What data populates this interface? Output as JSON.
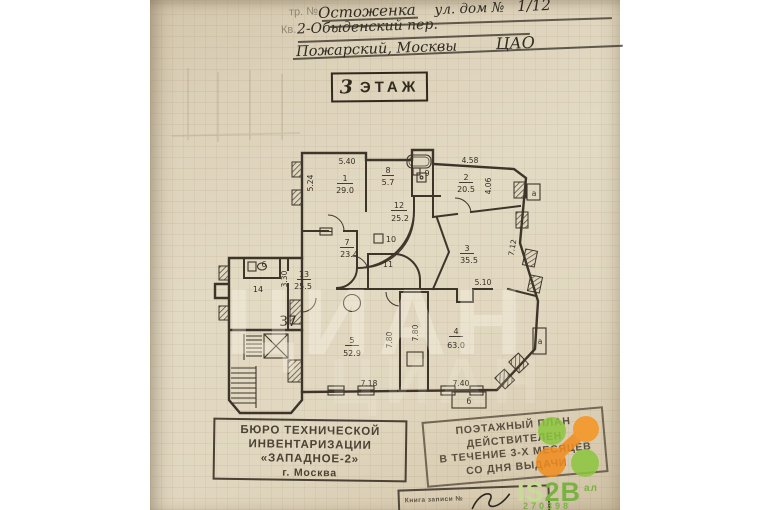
{
  "header": {
    "form_label_top": "тр. №",
    "form_label_kv": "Кв.",
    "street": "Остоженка",
    "street_mid": "ул. дом №",
    "house": "1/12",
    "line2": "2-Обыденский пер.",
    "line3": "Пожарский, Москвы",
    "okrug": "ЦАО"
  },
  "floor_stamp": {
    "number": "3",
    "word": "ЭТАЖ"
  },
  "plan": {
    "apartment_number": "37",
    "rooms": {
      "r1": {
        "num": "1",
        "area": "29.0"
      },
      "r2": {
        "num": "2",
        "area": "20.5"
      },
      "r3": {
        "num": "3",
        "area": "35.5"
      },
      "r4": {
        "num": "4",
        "area": "63.0"
      },
      "r5": {
        "num": "5",
        "area": "52.9"
      },
      "r6": {
        "num": "6"
      },
      "r7": {
        "num": "7",
        "area": "23.4"
      },
      "r8": {
        "num": "8",
        "area": "5.7"
      },
      "r9": {
        "num": "9"
      },
      "r10": {
        "num": "10"
      },
      "r11": {
        "num": "11"
      },
      "r12": {
        "num": "12",
        "area": "25.2"
      },
      "r13": {
        "num": "13",
        "area": "25.5"
      },
      "r14": {
        "num": "14"
      }
    },
    "dims": {
      "room1_w": "5.40",
      "room1_h": "5.24",
      "room2_w": "4.58",
      "room2_h": "4.06",
      "room3_h": "7.12",
      "room3_w": "5.10",
      "room13_h": "3.30",
      "room5_h": "7.80",
      "room4_h": "7.80",
      "room5_w": "7.18",
      "room4_w": "7.40"
    },
    "balconies": {
      "top": "а",
      "mid": "а",
      "bottom": "б"
    }
  },
  "stamps": {
    "bti": {
      "line1": "БЮРО ТЕХНИЧЕСКОЙ",
      "line2": "ИНВЕНТАРИЗАЦИИ",
      "line3": "«ЗАПАДНОЕ-2»",
      "line4": "г. Москва"
    },
    "validity": {
      "line1": "ПОЭТАЖНЫЙ ПЛАН",
      "line2": "ДЕЙСТВИТЕЛЕН",
      "line3": "В ТЕЧЕНИЕ 3-Х МЕСЯЦЕВ",
      "line4": "СО ДНЯ ВЫДАЧИ"
    },
    "registry_note": "Книга записи №"
  },
  "watermarks": {
    "cian": "ЦИАН",
    "is2b": {
      "part1": "IS",
      "part2": "2B",
      "sup": "ал",
      "number": "270398"
    }
  },
  "colors": {
    "ink": "#3a3128",
    "green": "#79b243",
    "light_green": "#c6dc96",
    "orange": "#f28c1e"
  }
}
